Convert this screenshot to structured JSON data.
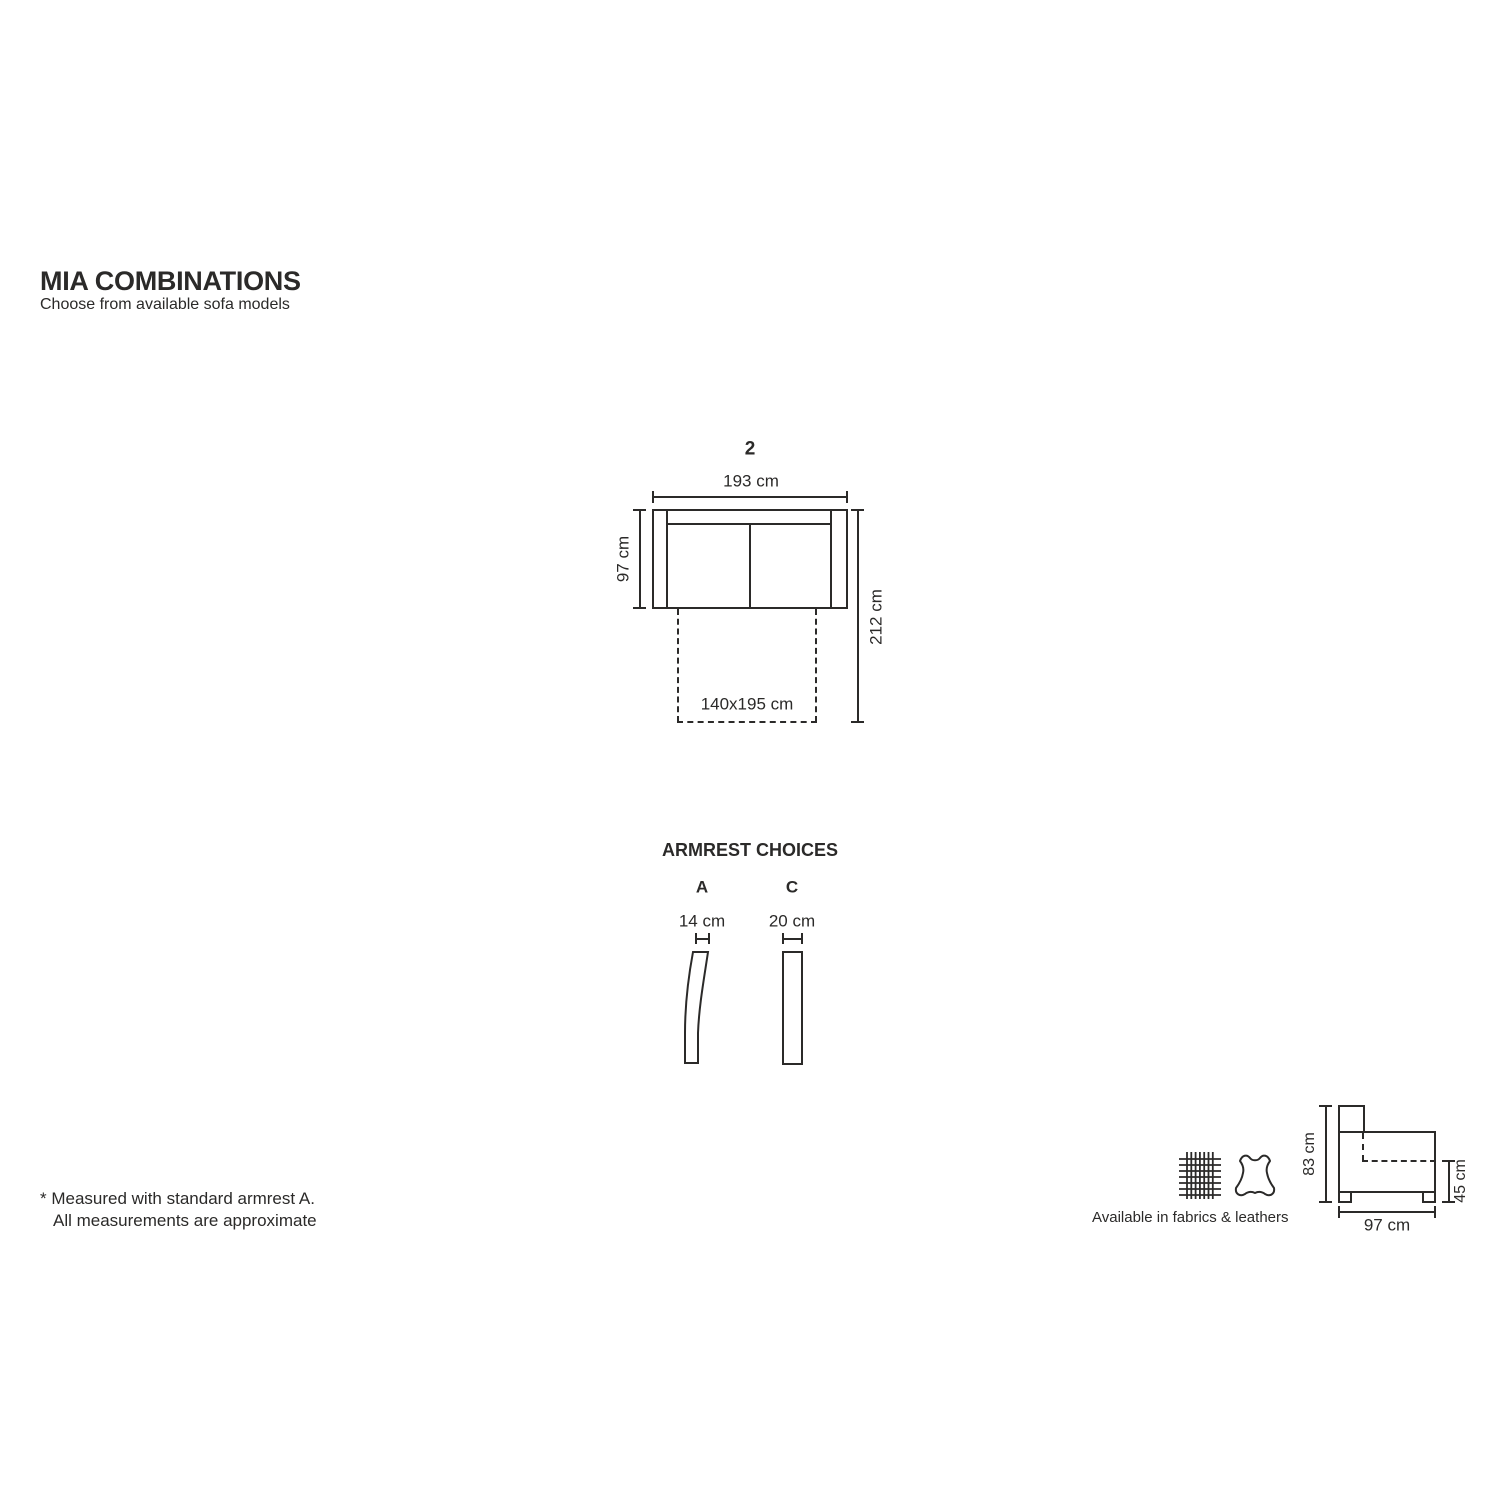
{
  "header": {
    "title": "MIA COMBINATIONS",
    "subtitle": "Choose from available sofa models"
  },
  "model": {
    "number": "2",
    "width_label": "193 cm",
    "depth_label": "97 cm",
    "extended_depth_label": "212 cm",
    "bed_size_label": "140x195 cm"
  },
  "armrests": {
    "heading": "ARMREST CHOICES",
    "options": [
      {
        "label": "A",
        "width_label": "14 cm"
      },
      {
        "label": "C",
        "width_label": "20 cm"
      }
    ]
  },
  "side_view": {
    "overall_height_label": "83 cm",
    "seat_height_label": "45 cm",
    "depth_label": "97 cm"
  },
  "materials": {
    "caption": "Available in fabrics & leathers",
    "icons": [
      "fabric-swatch-icon",
      "leather-hide-icon"
    ]
  },
  "footnote": {
    "line1": "* Measured with standard armrest A.",
    "line2": "All measurements are approximate"
  },
  "colors": {
    "ink": "#2b2a29",
    "background": "#ffffff"
  }
}
